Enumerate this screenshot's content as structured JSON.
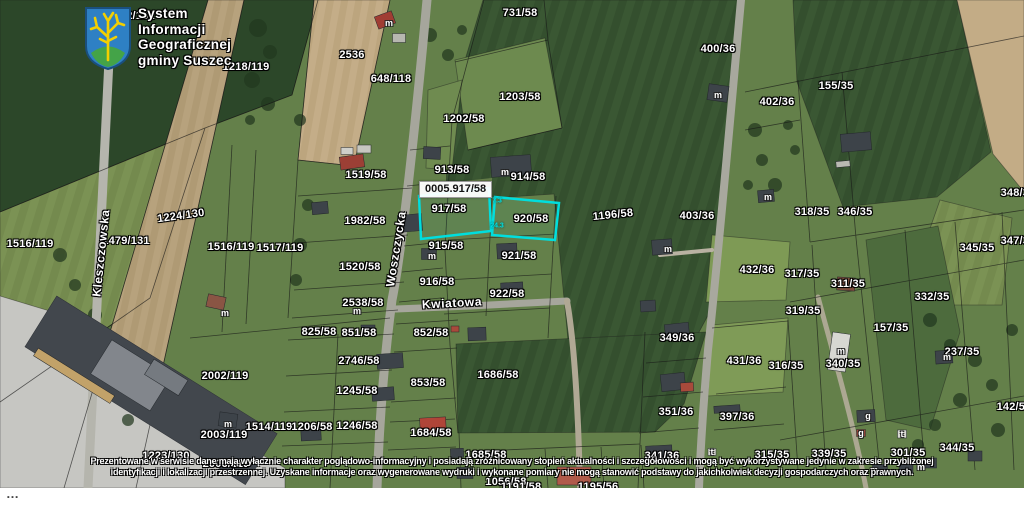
{
  "logo": {
    "lines": [
      "System",
      "Informacji",
      "Geograficznej",
      "gminy Suszec"
    ]
  },
  "map": {
    "selected_parcel_label": "0005.917/58",
    "highlight_color": "#00dede",
    "street_labels": [
      {
        "name": "Kleszczowska",
        "x": 101,
        "y": 253,
        "rot": -84
      },
      {
        "name": "Woszczycka",
        "x": 396,
        "y": 249,
        "rot": -81
      },
      {
        "name": "Kwiatowa",
        "x": 452,
        "y": 303,
        "rot": -3
      }
    ],
    "parcel_labels": [
      {
        "t": "2132/131",
        "x": 131,
        "y": 16
      },
      {
        "t": "731/58",
        "x": 520,
        "y": 13
      },
      {
        "t": "1218/119",
        "x": 246,
        "y": 67
      },
      {
        "t": "2536",
        "x": 352,
        "y": 55
      },
      {
        "t": "648/118",
        "x": 391,
        "y": 79
      },
      {
        "t": "400/36",
        "x": 718,
        "y": 49
      },
      {
        "t": "402/36",
        "x": 777,
        "y": 102
      },
      {
        "t": "155/35",
        "x": 836,
        "y": 86
      },
      {
        "t": "1203/58",
        "x": 520,
        "y": 97
      },
      {
        "t": "1202/58",
        "x": 464,
        "y": 119
      },
      {
        "t": "913/58",
        "x": 452,
        "y": 170
      },
      {
        "t": "914/58",
        "x": 528,
        "y": 177
      },
      {
        "t": "917/58",
        "x": 449,
        "y": 209
      },
      {
        "t": "920/58",
        "x": 531,
        "y": 219
      },
      {
        "t": "1196/58",
        "x": 613,
        "y": 215,
        "rot": -6
      },
      {
        "t": "403/36",
        "x": 697,
        "y": 216
      },
      {
        "t": "1224/130",
        "x": 181,
        "y": 216,
        "rot": -8
      },
      {
        "t": "1479/131",
        "x": 126,
        "y": 241
      },
      {
        "t": "1516/119",
        "x": 30,
        "y": 244
      },
      {
        "t": "1516/119",
        "x": 231,
        "y": 247
      },
      {
        "t": "1517/119",
        "x": 280,
        "y": 248
      },
      {
        "t": "1519/58",
        "x": 366,
        "y": 175
      },
      {
        "t": "1982/58",
        "x": 365,
        "y": 221
      },
      {
        "t": "915/58",
        "x": 446,
        "y": 246
      },
      {
        "t": "921/58",
        "x": 519,
        "y": 256
      },
      {
        "t": "916/58",
        "x": 437,
        "y": 282
      },
      {
        "t": "922/58",
        "x": 507,
        "y": 294
      },
      {
        "t": "1520/58",
        "x": 360,
        "y": 267
      },
      {
        "t": "2538/58",
        "x": 363,
        "y": 303
      },
      {
        "t": "825/58",
        "x": 319,
        "y": 332
      },
      {
        "t": "851/58",
        "x": 359,
        "y": 333
      },
      {
        "t": "852/58",
        "x": 431,
        "y": 333
      },
      {
        "t": "2746/58",
        "x": 359,
        "y": 361
      },
      {
        "t": "853/58",
        "x": 428,
        "y": 383
      },
      {
        "t": "2002/119",
        "x": 225,
        "y": 376
      },
      {
        "t": "1245/58",
        "x": 357,
        "y": 391
      },
      {
        "t": "2003/119",
        "x": 224,
        "y": 435
      },
      {
        "t": "1514/119",
        "x": 269,
        "y": 427
      },
      {
        "t": "1206/58",
        "x": 312,
        "y": 427
      },
      {
        "t": "1246/58",
        "x": 357,
        "y": 426
      },
      {
        "t": "1684/58",
        "x": 431,
        "y": 433
      },
      {
        "t": "1686/58",
        "x": 498,
        "y": 375
      },
      {
        "t": "1685/58",
        "x": 486,
        "y": 455
      },
      {
        "t": "1223/130",
        "x": 166,
        "y": 456
      },
      {
        "t": "2006/119",
        "x": 226,
        "y": 464
      },
      {
        "t": "1056/58",
        "x": 506,
        "y": 482
      },
      {
        "t": "1191/58",
        "x": 521,
        "y": 487
      },
      {
        "t": "1195/56",
        "x": 598,
        "y": 487
      },
      {
        "t": "318/35",
        "x": 812,
        "y": 212
      },
      {
        "t": "346/35",
        "x": 855,
        "y": 212
      },
      {
        "t": "348/35",
        "x": 1018,
        "y": 193
      },
      {
        "t": "345/35",
        "x": 977,
        "y": 248
      },
      {
        "t": "347/35",
        "x": 1018,
        "y": 241
      },
      {
        "t": "317/35",
        "x": 802,
        "y": 274
      },
      {
        "t": "311/35",
        "x": 848,
        "y": 284
      },
      {
        "t": "332/35",
        "x": 932,
        "y": 297
      },
      {
        "t": "319/35",
        "x": 803,
        "y": 311
      },
      {
        "t": "157/35",
        "x": 891,
        "y": 328
      },
      {
        "t": "340/35",
        "x": 843,
        "y": 364
      },
      {
        "t": "237/35",
        "x": 962,
        "y": 352
      },
      {
        "t": "142/58",
        "x": 1014,
        "y": 407
      },
      {
        "t": "431/36",
        "x": 744,
        "y": 361
      },
      {
        "t": "316/35",
        "x": 786,
        "y": 366
      },
      {
        "t": "349/36",
        "x": 677,
        "y": 338
      },
      {
        "t": "351/36",
        "x": 676,
        "y": 412
      },
      {
        "t": "397/36",
        "x": 737,
        "y": 417
      },
      {
        "t": "341/36",
        "x": 662,
        "y": 456
      },
      {
        "t": "315/35",
        "x": 772,
        "y": 455
      },
      {
        "t": "344/35",
        "x": 957,
        "y": 448
      },
      {
        "t": "301/35",
        "x": 908,
        "y": 453
      },
      {
        "t": "432/36",
        "x": 757,
        "y": 270
      },
      {
        "t": "339/35",
        "x": 829,
        "y": 454
      }
    ],
    "dimension_labels": [
      {
        "t": "7.3",
        "x": 497,
        "y": 201
      },
      {
        "t": "24.3",
        "x": 497,
        "y": 226
      }
    ],
    "building_markers": [
      {
        "t": "m",
        "x": 389,
        "y": 23
      },
      {
        "t": "m",
        "x": 718,
        "y": 95
      },
      {
        "t": "m",
        "x": 768,
        "y": 197
      },
      {
        "t": "m",
        "x": 505,
        "y": 172
      },
      {
        "t": "m",
        "x": 432,
        "y": 256
      },
      {
        "t": "m",
        "x": 357,
        "y": 311
      },
      {
        "t": "m",
        "x": 225,
        "y": 313
      },
      {
        "t": "m",
        "x": 668,
        "y": 249
      },
      {
        "t": "m",
        "x": 228,
        "y": 424
      },
      {
        "t": "m",
        "x": 841,
        "y": 351
      },
      {
        "t": "m",
        "x": 947,
        "y": 357
      },
      {
        "t": "m",
        "x": 874,
        "y": 470
      },
      {
        "t": "m",
        "x": 921,
        "y": 467
      },
      {
        "t": "t",
        "x": 902,
        "y": 434
      },
      {
        "t": "t",
        "x": 712,
        "y": 452
      },
      {
        "t": "g",
        "x": 868,
        "y": 416
      },
      {
        "t": "g",
        "x": 861,
        "y": 433
      }
    ]
  },
  "disclaimer": {
    "line1": "Prezentowane w serwisie dane mają wyłącznie charakter poglądowo-informacyjny i posiadają zróżnicowany stopień aktualności i szczegółowości i mogą być wykorzystywane jedynie w zakresie przybliżonej",
    "line2": "identyfikacji i lokalizacji przestrzennej. Uzyskane informacje oraz wygenerowane wydruki i wykonane pomiary nie mogą stanowić podstawy do jakichkolwiek decyzji gospodarczych oraz prawnych."
  },
  "footer": {
    "ellipsis": "…"
  }
}
